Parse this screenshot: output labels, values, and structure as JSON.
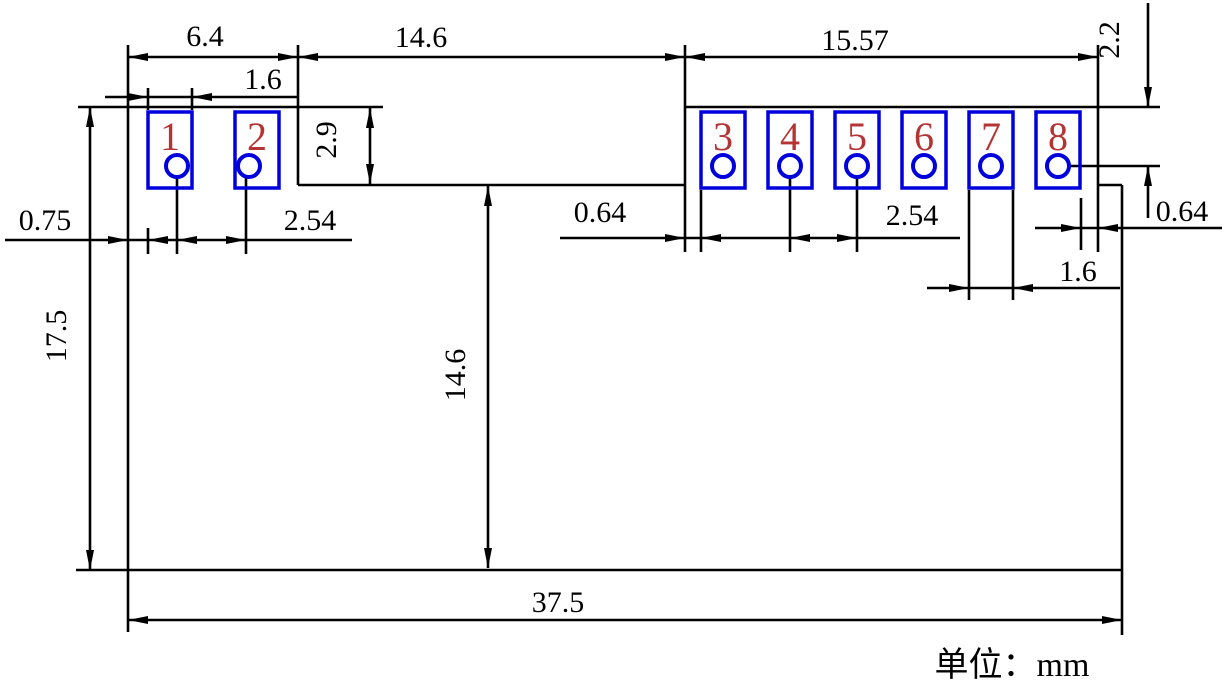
{
  "drawing": {
    "type": "mechanical-dimension-drawing",
    "unit_note": "单位：mm",
    "colors": {
      "line": "#000000",
      "pad_outline": "#0000dd",
      "pad_number": "#b43434",
      "background": "#ffffff"
    },
    "pads": [
      {
        "number": "1"
      },
      {
        "number": "2"
      },
      {
        "number": "3"
      },
      {
        "number": "4"
      },
      {
        "number": "5"
      },
      {
        "number": "6"
      },
      {
        "number": "7"
      },
      {
        "number": "8"
      }
    ],
    "dims": {
      "left_section_width": "6.4",
      "pad1_width": "1.6",
      "notch_width": "14.6",
      "right_section_width": "15.57",
      "edge_to_hole_row": "2.2",
      "notch_depth": "2.9",
      "edge_to_pad1": "0.75",
      "pitch_left": "2.54",
      "notch_to_pad3": "0.64",
      "pitch_right": "2.54",
      "pad8_to_edge": "0.64",
      "pad7_width": "1.6",
      "body_height": "17.5",
      "notch_to_bottom": "14.6",
      "body_width": "37.5"
    }
  }
}
